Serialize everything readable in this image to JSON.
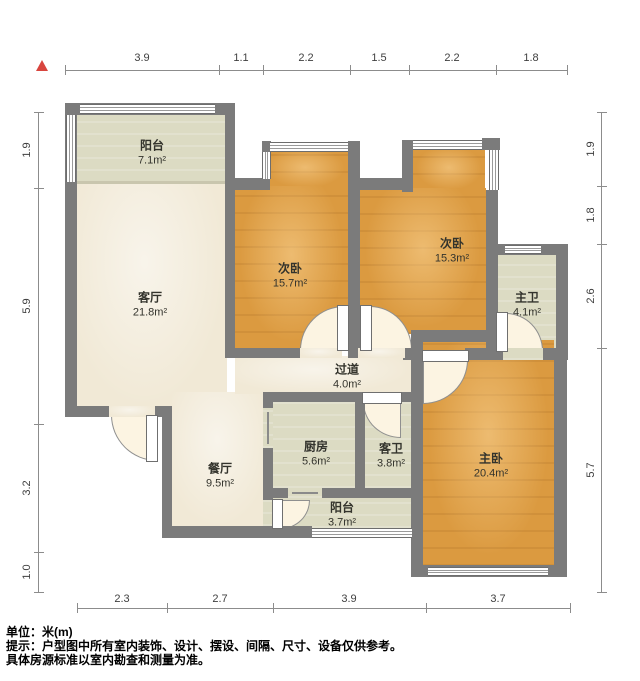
{
  "icons": {
    "north": "triangle-up"
  },
  "colors": {
    "wall": "#7b7b7b",
    "floor_living": "#f1e9d6",
    "floor_bedroom": "#db9a40",
    "floor_service": "#dcdbc3",
    "north_arrow": "#d8453e"
  },
  "rooms": [
    {
      "name": "阳台",
      "area": "7.1m²"
    },
    {
      "name": "客厅",
      "area": "21.8m²"
    },
    {
      "name": "次卧",
      "area": "15.7m²"
    },
    {
      "name": "次卧",
      "area": "15.3m²"
    },
    {
      "name": "主卫",
      "area": "4.1m²"
    },
    {
      "name": "过道",
      "area": "4.0m²"
    },
    {
      "name": "厨房",
      "area": "5.6m²"
    },
    {
      "name": "客卫",
      "area": "3.8m²"
    },
    {
      "name": "主卧",
      "area": "20.4m²"
    },
    {
      "name": "餐厅",
      "area": "9.5m²"
    },
    {
      "name": "阳台",
      "area": "3.7m²"
    }
  ],
  "dimensions": {
    "top": [
      "3.9",
      "1.1",
      "2.2",
      "1.5",
      "2.2",
      "1.8"
    ],
    "bottom": [
      "2.3",
      "2.7",
      "3.9",
      "3.7"
    ],
    "left": [
      "1.9",
      "5.9",
      "3.2",
      "1.0"
    ],
    "right": [
      "1.9",
      "1.8",
      "2.6",
      "5.7"
    ]
  },
  "footer": {
    "unit_line": "单位：米(m)",
    "note_line1": "提示：户型图中所有室内装饰、设计、摆设、间隔、尺寸、设备仅供参考。",
    "note_line2": "具体房源标准以室内勘查和测量为准。"
  }
}
